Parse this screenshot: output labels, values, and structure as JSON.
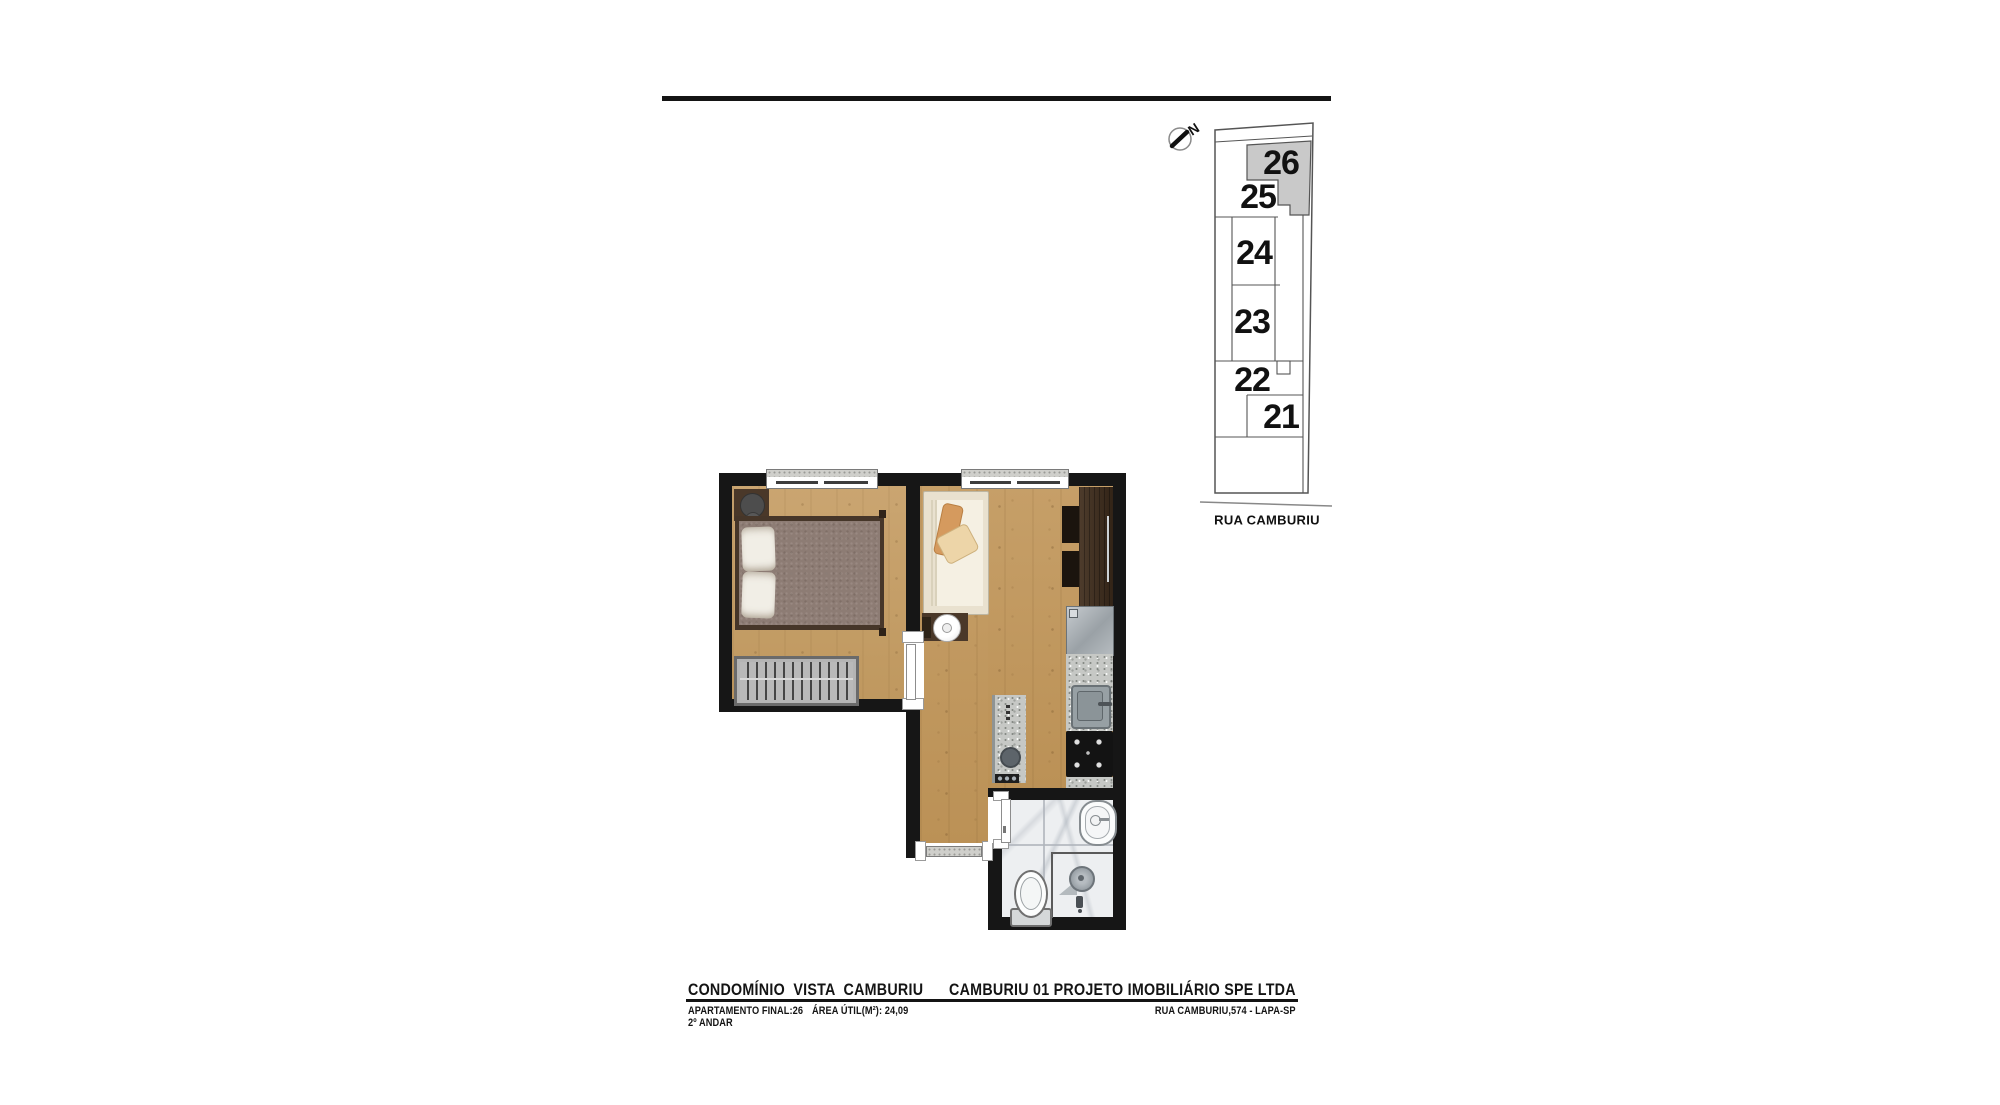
{
  "keyplan": {
    "north_label": "N",
    "street_label": "RUA CAMBURIU",
    "highlight_color": "#c9c9c9",
    "units": [
      {
        "number": "21",
        "highlighted": false
      },
      {
        "number": "22",
        "highlighted": false
      },
      {
        "number": "23",
        "highlighted": false
      },
      {
        "number": "24",
        "highlighted": false
      },
      {
        "number": "25",
        "highlighted": false
      },
      {
        "number": "26",
        "highlighted": true
      }
    ]
  },
  "floorplan": {
    "highlighted_unit": "26",
    "colors": {
      "wall": "#161616",
      "wood_floor": "#c29a63",
      "marble_floor": "#edeff1",
      "granite": "#c6c8c5",
      "bed_duvet": "#8d7c74",
      "sofa_cream": "#e9e1cf",
      "pillow_tan": "#d59a5e"
    }
  },
  "footer": {
    "project_title": "CONDOMÍNIO  VISTA  CAMBURIU",
    "developer_title": "CAMBURIU 01 PROJETO IMOBILIÁRIO SPE LTDA",
    "apartment_label": "APARTAMENTO FINAL:26",
    "area_label": "ÁREA ÚTIL(M²): 24,09",
    "floor_label": "2º ANDAR",
    "address_label": "RUA CAMBURIU,574 - LAPA-SP"
  }
}
